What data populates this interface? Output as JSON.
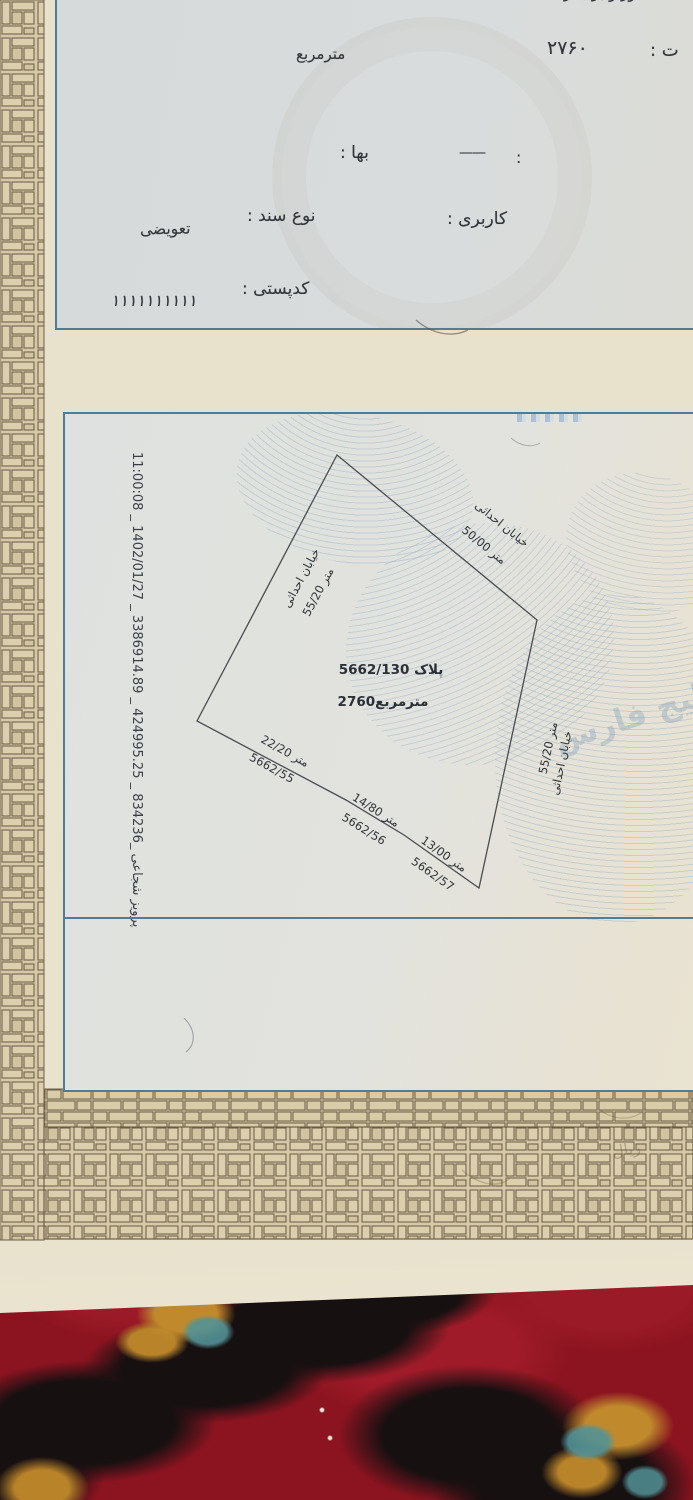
{
  "doc": {
    "colors": {
      "border_blue": "#4e7e96",
      "paper_cream": "#e8e1cb",
      "panel_gray": "#d6dadb",
      "pattern_tan": "#d7c9a7",
      "pattern_line": "#6d5f47",
      "carpet_red": "#8c1420",
      "carpet_gold": "#c08a2c",
      "carpet_teal": "#4d8d92"
    },
    "header": {
      "top_partial": "ور و بری از :",
      "top_partial_center": "ـعه",
      "area_label_fragment": "ت :",
      "area_value": "۲۷۶۰",
      "area_unit": "مترمربع",
      "price_label": "بها :",
      "dash_colon": ":",
      "dash_value": "——",
      "usage_label": "کاربری :",
      "doc_type_label": "نوع سند :",
      "doc_type_value": "تعویضی",
      "postal_label": "کدپستی :",
      "postal_value": "۱۱۱۱۱۱۱۱۱۱"
    },
    "map": {
      "stamp_line": "11:00:08 _ 1402/01/27 _ 3386914.89 _ 424995.25 _ 834236_ پرویز شجاعی",
      "plot_label": "پلاک 5662/130",
      "plot_area": "2760مترمربع",
      "street_top": "خیابان احداثی",
      "street_left": "خیابان احداثی",
      "street_right": "خیابان احداثی",
      "len_top": "50/00 متر",
      "len_left": "55/20 متر",
      "len_right": "55/20 متر",
      "segments": [
        {
          "length": "22/20 متر",
          "parcel": "5662/55"
        },
        {
          "length": "14/80 متر",
          "parcel": "5662/56"
        },
        {
          "length": "13/00 متر",
          "parcel": "5662/57"
        }
      ],
      "gulf_watermark": "خلیج فارس",
      "rial_note": "ریال"
    }
  }
}
